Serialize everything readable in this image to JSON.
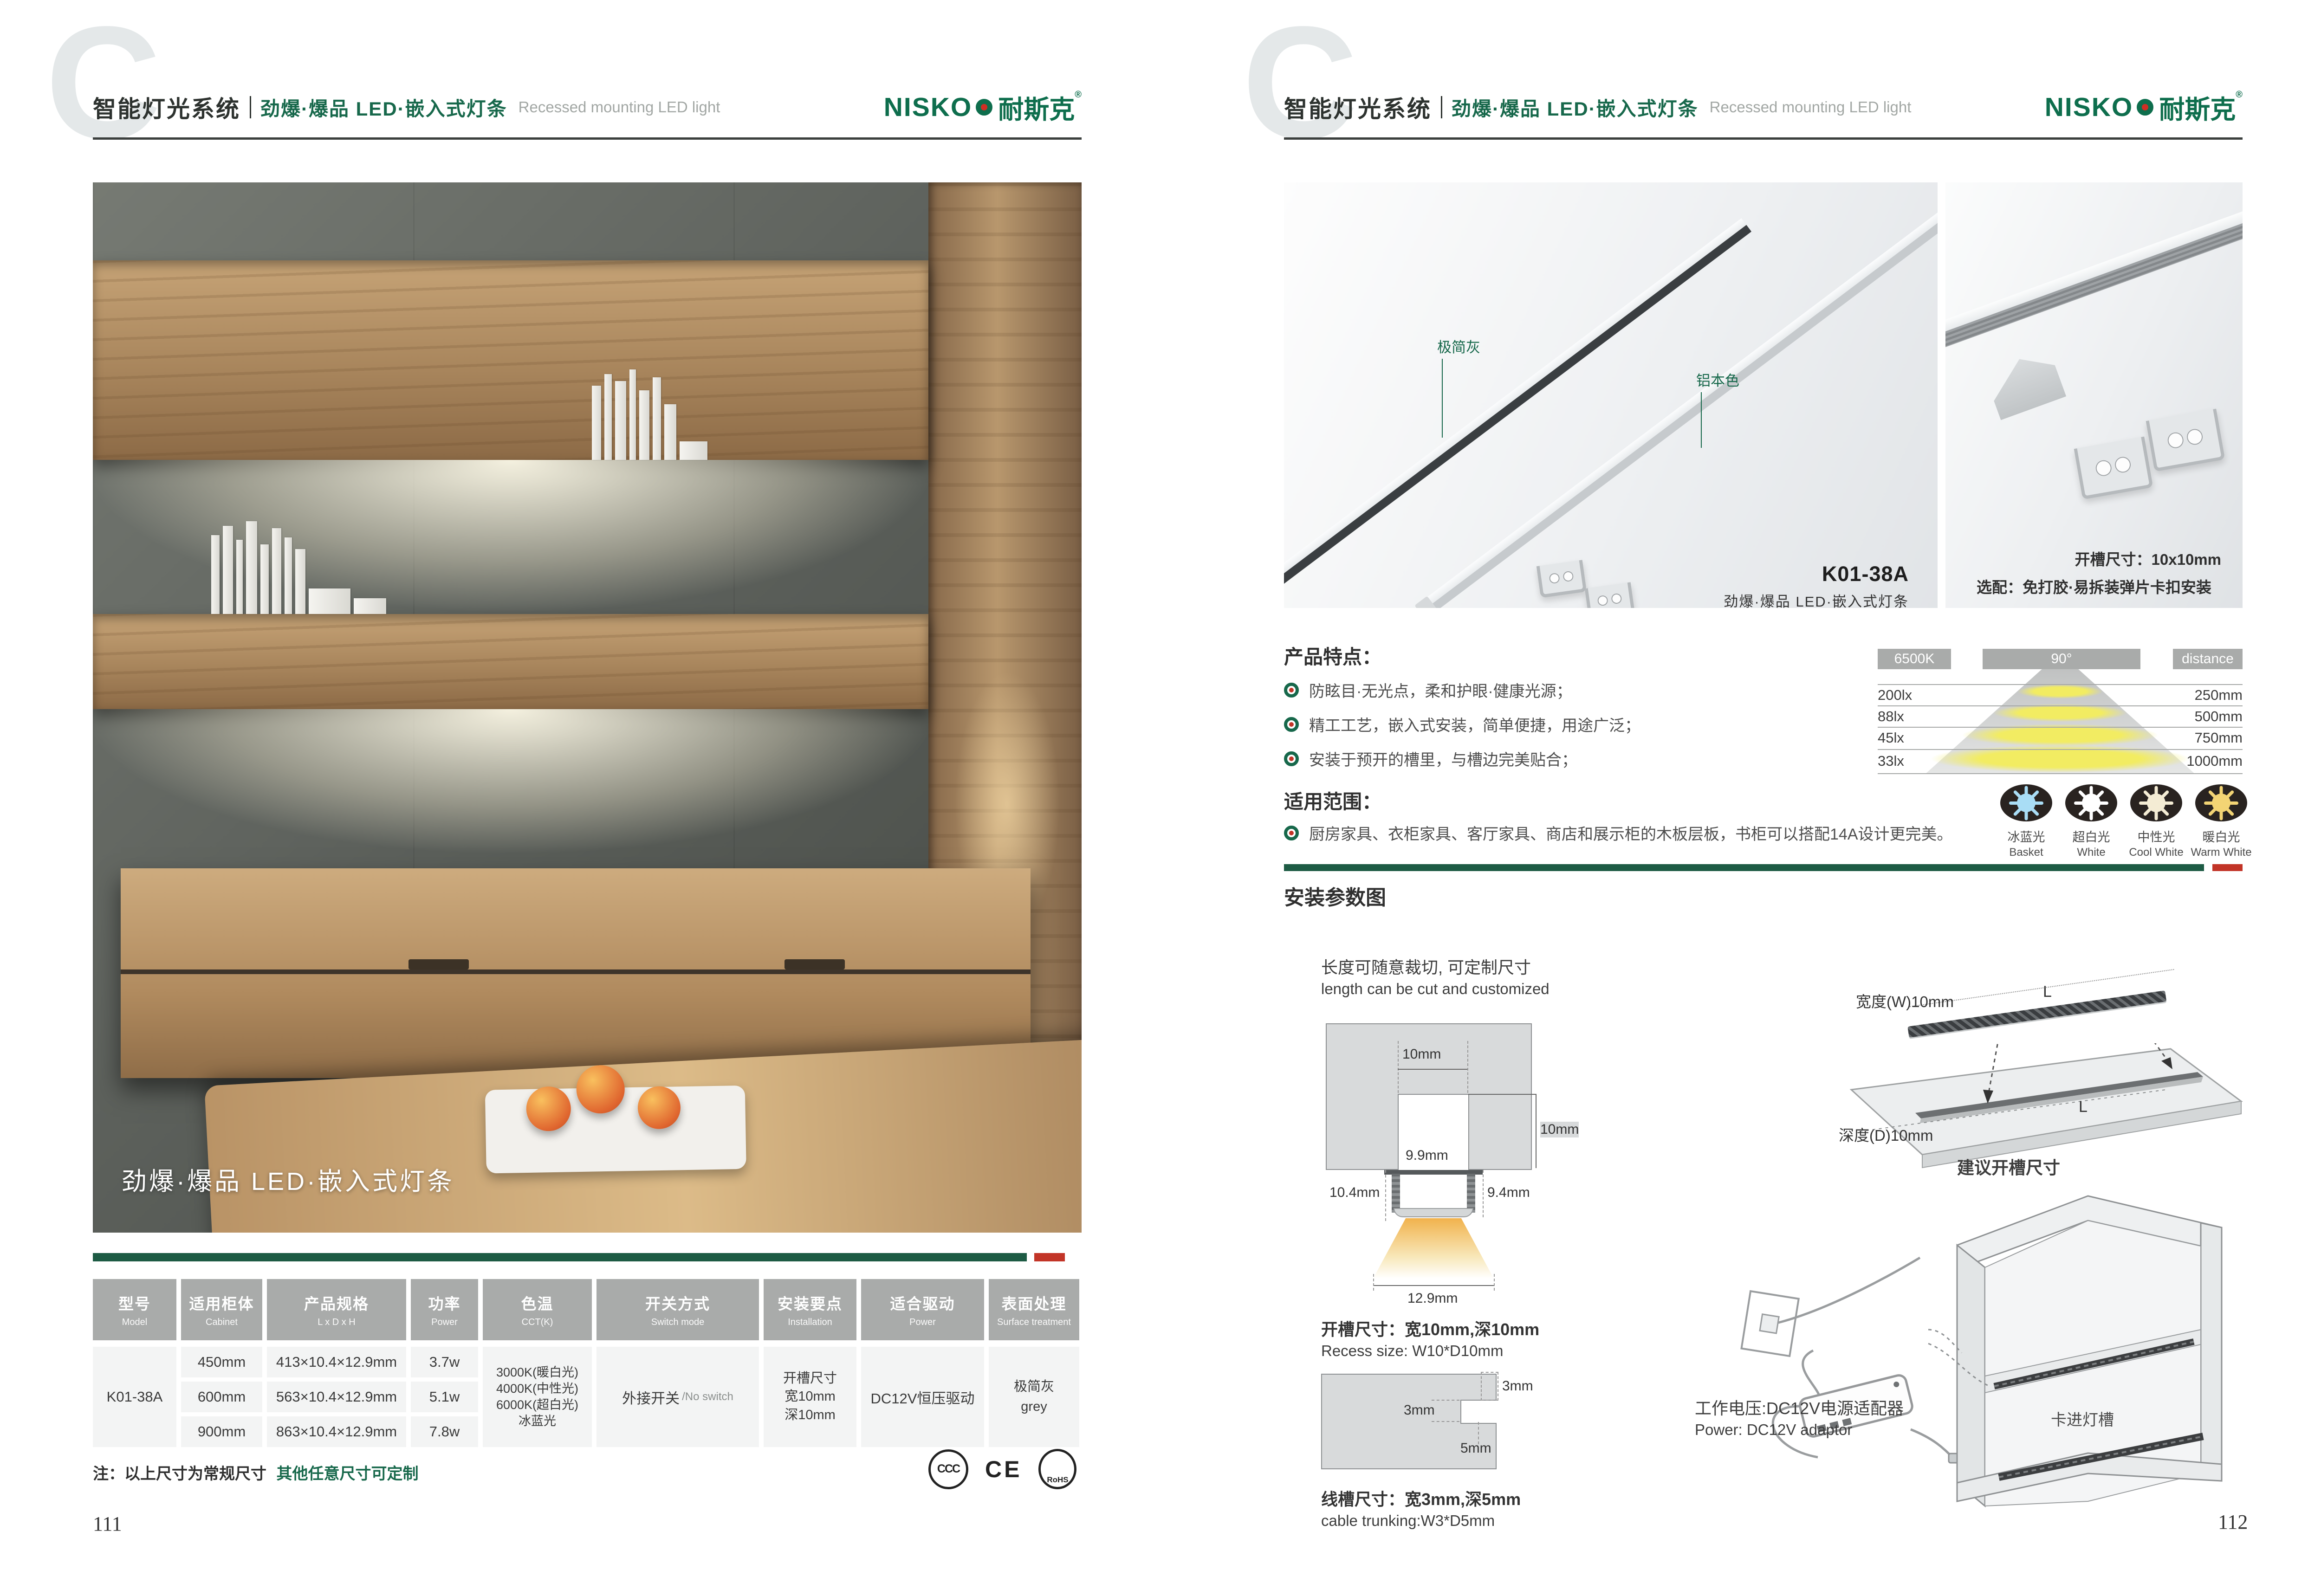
{
  "header": {
    "watermark": "C",
    "system_title": "智能灯光系统",
    "series_title": "劲爆·爆品  LED·嵌入式灯条",
    "series_subtitle_en": "Recessed mounting LED light",
    "brand_latin": "NISKO",
    "brand_cn": "耐斯克",
    "brand_reg": "®"
  },
  "colors": {
    "brand_green": "#17684b",
    "accent_red": "#c23427",
    "table_header_grey": "#a9abaa",
    "separator_green": "#1d5b44"
  },
  "left_page": {
    "photo_overlay": "劲爆·爆品  LED·嵌入式灯条",
    "table": {
      "columns": [
        {
          "cn": "型号",
          "en": "Model"
        },
        {
          "cn": "适用柜体",
          "en": "Cabinet"
        },
        {
          "cn": "产品规格",
          "en": "L x D x H"
        },
        {
          "cn": "功率",
          "en": "Power"
        },
        {
          "cn": "色温",
          "en": "CCT(K)"
        },
        {
          "cn": "开关方式",
          "en": "Switch mode"
        },
        {
          "cn": "安装要点",
          "en": "Installation"
        },
        {
          "cn": "适合驱动",
          "en": "Power"
        },
        {
          "cn": "表面处理",
          "en": "Surface treatment"
        }
      ],
      "model": "K01-38A",
      "rows": [
        {
          "cabinet": "450mm",
          "spec": "413×10.4×12.9mm",
          "power": "3.7w"
        },
        {
          "cabinet": "600mm",
          "spec": "563×10.4×12.9mm",
          "power": "5.1w"
        },
        {
          "cabinet": "900mm",
          "spec": "863×10.4×12.9mm",
          "power": "7.8w"
        }
      ],
      "cct_lines": [
        "3000K(暖白光)",
        "4000K(中性光)",
        "6000K(超白光)",
        "冰蓝光"
      ],
      "switch_cn": "外接开关",
      "switch_en": "/No switch",
      "install_lines": [
        "开槽尺寸",
        "宽10mm",
        "深10mm"
      ],
      "driver": "DC12V恒压驱动",
      "surface_cn": "极简灰",
      "surface_en": "grey"
    },
    "note_prefix": "注：以上尺寸为常规尺寸",
    "note_green": "其他任意尺寸可定制",
    "certs": {
      "c1": "CCC",
      "c2": "CE",
      "c3": "RoHS"
    },
    "page_number": "111"
  },
  "right_page": {
    "photo1": {
      "label_grey": "极简灰",
      "label_aluminum": "铝本色",
      "model": "K01-38A",
      "caption": "劲爆·爆品  LED·嵌入式灯条"
    },
    "photo2": {
      "line1": "开槽尺寸：10x10mm",
      "line2": "选配：免打胶·易拆装弹片卡扣安装"
    },
    "features_title": "产品特点：",
    "features": [
      "防眩目·无光点，柔和护眼·健康光源；",
      "精工工艺，嵌入式安装，简单便捷，用途广泛；",
      "安装于预开的槽里，与槽边完美贴合；"
    ],
    "scope_title": "适用范围：",
    "scope_text": "厨房家具、衣柜家具、客厅家具、商店和展示柜的木板层板，书柜可以搭配14A设计更完美。",
    "light_chart": {
      "col_headers": [
        "6500K",
        "90°",
        "distance"
      ],
      "rows": [
        {
          "lux": "200lx",
          "distance": "250mm"
        },
        {
          "lux": "88lx",
          "distance": "500mm"
        },
        {
          "lux": "45lx",
          "distance": "750mm"
        },
        {
          "lux": "33lx",
          "distance": "1000mm"
        }
      ],
      "swatches": [
        {
          "cn": "冰蓝光",
          "en": "Basket",
          "color": "#a9ddf5"
        },
        {
          "cn": "超白光",
          "en": "White",
          "color": "#ffffff"
        },
        {
          "cn": "中性光",
          "en": "Cool White",
          "color": "#f4ecd4"
        },
        {
          "cn": "暖白光",
          "en": "Warm White",
          "color": "#f3d474"
        }
      ]
    },
    "install": {
      "section_title": "安装参数图",
      "cut_note_cn": "长度可随意裁切, 可定制尺寸",
      "cut_note_en": "length can be cut and customized",
      "cross_section": {
        "top": "10mm",
        "depth": "10mm",
        "inner": "9.9mm",
        "left": "10.4mm",
        "right": "9.4mm",
        "bottom": "12.9mm"
      },
      "recess_cn": "开槽尺寸：宽10mm,深10mm",
      "recess_en": "Recess size: W10*D10mm",
      "trunk": {
        "t": "3mm",
        "l": "3mm",
        "d": "5mm"
      },
      "trunk_cn": "线槽尺寸：宽3mm,深5mm",
      "trunk_en": "cable trunking:W3*D5mm",
      "board": {
        "l1": "L",
        "l2": "L",
        "width": "宽度(W)10mm",
        "depth": "深度(D)10mm",
        "caption": "建议开槽尺寸"
      },
      "power_cn": "工作电压:DC12V电源适配器",
      "power_en": "Power: DC12V adaptor",
      "cabinet_label": "卡进灯槽"
    },
    "page_number": "112"
  }
}
